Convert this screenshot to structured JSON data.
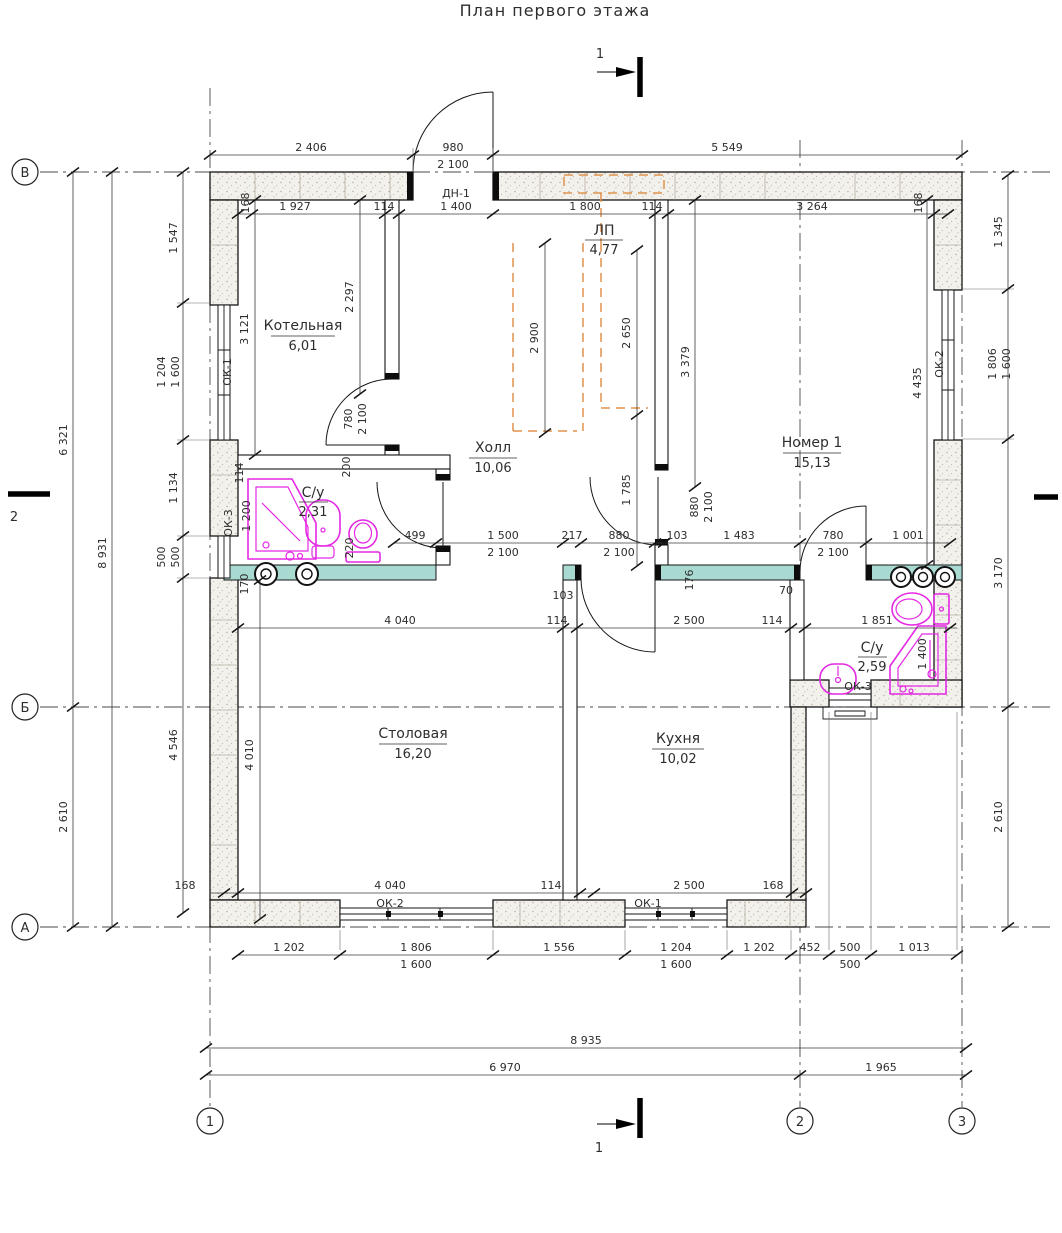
{
  "title": "План первого этажа",
  "axis_bubbles": {
    "row": [
      "В",
      "Б",
      "А"
    ],
    "col": [
      "1",
      "2",
      "3"
    ]
  },
  "section_marks": {
    "top": "1",
    "bottom": "1",
    "left": "2"
  },
  "rooms": {
    "kotelnaya": {
      "name": "Котельная",
      "area": "6,01"
    },
    "su1": {
      "name": "С/у",
      "area": "2,31"
    },
    "hall": {
      "name": "Холл",
      "area": "10,06"
    },
    "nomer1": {
      "name": "Номер 1",
      "area": "15,13"
    },
    "stolovaya": {
      "name": "Столовая",
      "area": "16,20"
    },
    "kuhnya": {
      "name": "Кухня",
      "area": "10,02"
    },
    "su2": {
      "name": "С/у",
      "area": "2,59"
    },
    "stair": {
      "name": "ЛП",
      "area": "4,77"
    }
  },
  "openings": {
    "entry_door": "ДН-1",
    "ok1": "ОК-1",
    "ok2": "ОК-2",
    "ok3": "ОК-3"
  },
  "dims": {
    "top_outer": [
      "2 406",
      "980",
      "2 100",
      "5 549"
    ],
    "top_inner": [
      "168",
      "1 927",
      "114",
      "1 400",
      "1 800",
      "114",
      "3 264",
      "168"
    ],
    "left_outer": [
      "6 321",
      "2 610",
      "8 931"
    ],
    "left_inner": [
      "1 547",
      "1 204",
      "1 600",
      "1 134",
      "500",
      "500",
      "4 546"
    ],
    "right_outer": [
      "1 345",
      "1 806",
      "1 600",
      "3 170",
      "2 610"
    ],
    "mid": [
      "499",
      "1 500",
      "2 100",
      "217",
      "880",
      "2 100",
      "103",
      "1 483",
      "780",
      "2 100",
      "1 001"
    ],
    "mid2": [
      "4 040",
      "114",
      "2 500",
      "114",
      "1 851"
    ],
    "bottom_inner": [
      "168",
      "4 040",
      "114",
      "2 500",
      "168"
    ],
    "bottom_win": [
      "1 202",
      "1 806",
      "1 600",
      "1 556",
      "1 204",
      "1 600",
      "1 202",
      "452",
      "500",
      "500",
      "1 013"
    ],
    "bottom_overall": [
      "8 935",
      "6 970",
      "1 965"
    ],
    "interior": [
      "3 121",
      "2 297",
      "780",
      "2 100",
      "200",
      "114",
      "1 200",
      "220",
      "170",
      "2 900",
      "2 650",
      "1 785",
      "3 379",
      "880",
      "2 100",
      "4 435",
      "4 010",
      "103",
      "70",
      "176",
      "1 400"
    ]
  },
  "colors": {
    "teal_wall": "#a9dad1",
    "stair_orange": "#e2924d",
    "plumbing_magenta": "#e428e4"
  }
}
